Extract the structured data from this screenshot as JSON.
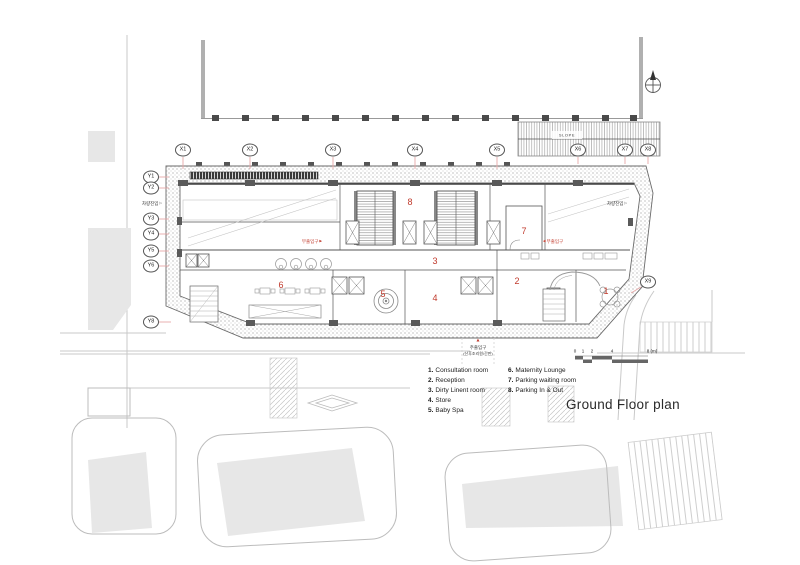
{
  "title": "Ground Floor plan",
  "colors": {
    "annotation_red": "#c0392b",
    "plan_line": "#4a4a4a",
    "road_gray": "#c9c9c9",
    "building_fill": "#e7e7e7"
  },
  "grid": {
    "x": [
      "X1",
      "X2",
      "X3",
      "X4",
      "X5",
      "X6",
      "X7",
      "X8",
      "X9"
    ],
    "y": [
      "Y1",
      "Y2",
      "Y3",
      "Y4",
      "Y5",
      "Y6",
      "Y8"
    ]
  },
  "rooms": [
    "1",
    "2",
    "3",
    "4",
    "5",
    "6",
    "7",
    "8"
  ],
  "legend": {
    "col1": [
      {
        "num": "1.",
        "label": "Consultation room"
      },
      {
        "num": "2.",
        "label": "Reception"
      },
      {
        "num": "3.",
        "label": "Dirty Linent room"
      },
      {
        "num": "4.",
        "label": "Store"
      },
      {
        "num": "5.",
        "label": "Baby Spa"
      }
    ],
    "col2": [
      {
        "num": "6.",
        "label": "Maternity Lounge"
      },
      {
        "num": "7.",
        "label": "Parking waiting room"
      },
      {
        "num": "8.",
        "label": "Parking In & Out"
      }
    ]
  },
  "scale_bar": {
    "ticks": [
      "0",
      "1",
      "2",
      "4"
    ],
    "end_label": "8 (m)"
  },
  "annotations": {
    "slope": "SLOPE",
    "vehicle_entry_left": "차량진입",
    "vehicle_entry_right": "차량진입",
    "sub_entrance_left": "부출입구",
    "sub_entrance_right": "부출입구",
    "main_entrance_title": "주출입구",
    "main_entrance_sub": "(산후조리원/간판)"
  },
  "icons": {
    "arrow_right_small": "▶",
    "arrow_left_small": "◀",
    "arrow_outline_right": "▷",
    "entrance_marker": "▲"
  }
}
